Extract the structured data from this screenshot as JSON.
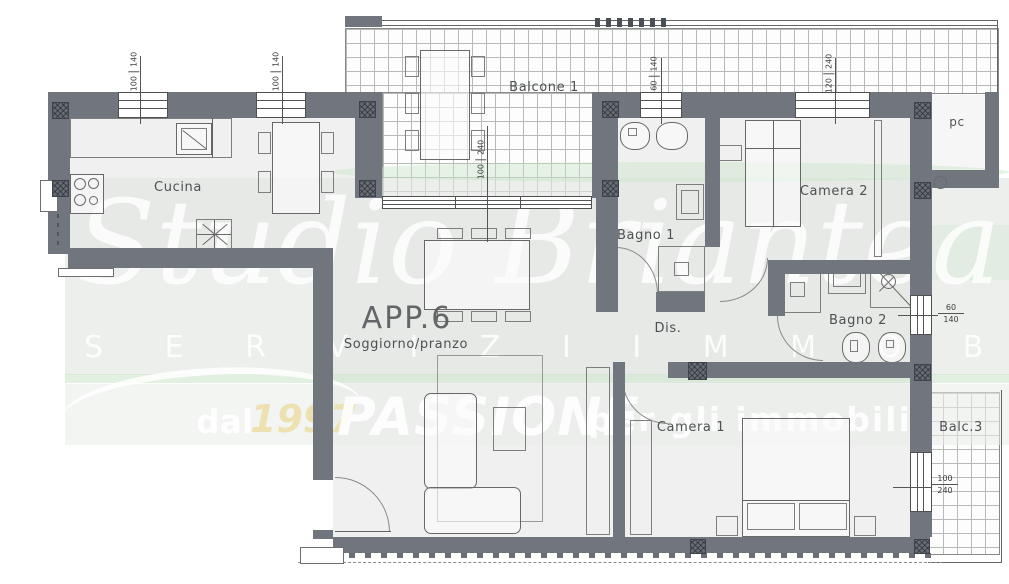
{
  "watermark": {
    "brand": "Studio Briantea",
    "subtitle": "S E R V I Z I   I M M O B I L I A R I",
    "since": "dal",
    "year": "1997",
    "passion": "PASSIONE",
    "tagline": "per gli immobili"
  },
  "plan": {
    "apartment": "APP.6",
    "rooms": {
      "cucina": "Cucina",
      "balcone1": "Balcone 1",
      "bagno1": "Bagno 1",
      "camera2": "Camera 2",
      "pc": "pc",
      "dis": "Dis.",
      "bagno2": "Bagno 2",
      "soggiorno": "Soggiorno/pranzo",
      "camera1": "Camera 1",
      "balc3": "Balc.3"
    },
    "window_dimensions": [
      {
        "id": "kitchen-window-1",
        "w": "100",
        "h": "140"
      },
      {
        "id": "kitchen-window-2",
        "w": "100",
        "h": "140"
      },
      {
        "id": "bagno1-window",
        "w": "60",
        "h": "140"
      },
      {
        "id": "camera2-window",
        "w": "120",
        "h": "240"
      },
      {
        "id": "living-window",
        "w": "100",
        "h": "240"
      },
      {
        "id": "bagno2-window",
        "w": "60",
        "h": "140"
      },
      {
        "id": "camera1-window",
        "w": "100",
        "h": "240"
      }
    ]
  },
  "colors": {
    "wall": "#71767e",
    "hatch": "#686d75",
    "band": "#e9ece9",
    "accent_green": "#cfe5cf",
    "year_text": "#ecdfae"
  }
}
